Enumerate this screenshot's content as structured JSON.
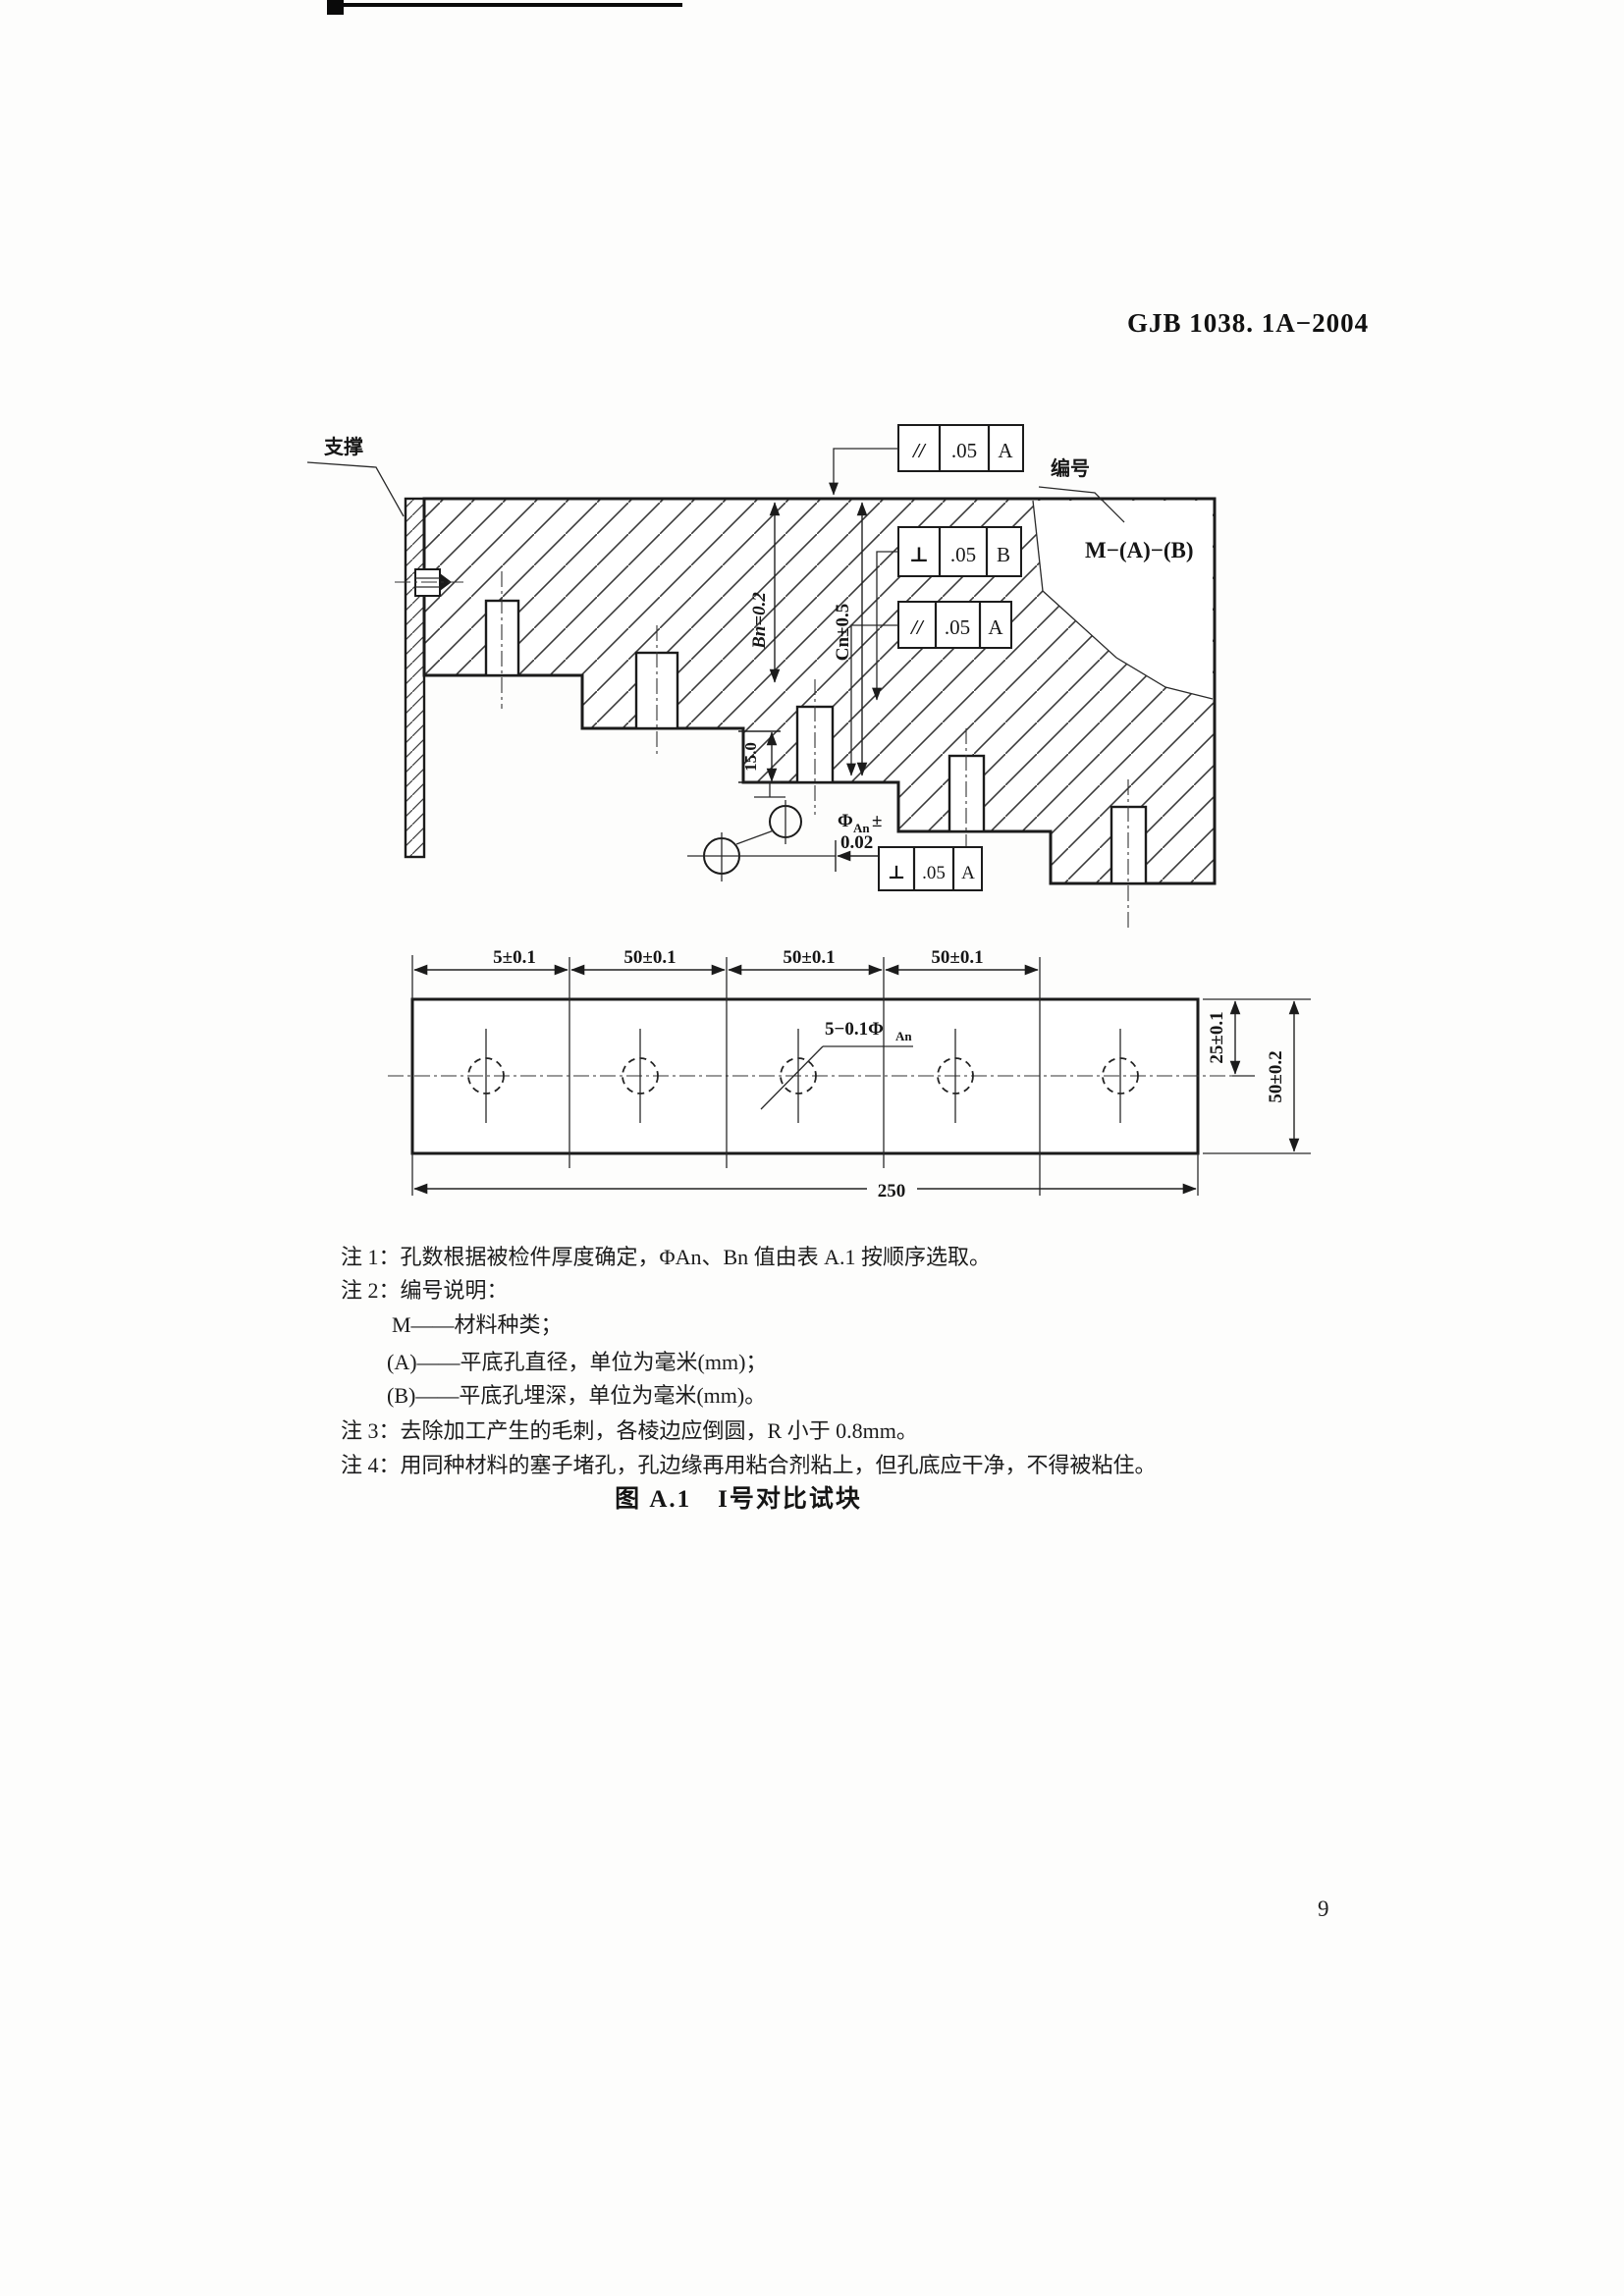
{
  "page": {
    "standard_number": "GJB 1038. 1A−2004",
    "page_number": "9"
  },
  "figure": {
    "caption": "图 A.1　I号对比试块",
    "section_view": {
      "support_label": "支撑",
      "id_label": "编号",
      "marking": "M−(A)−(B)",
      "frames": {
        "top": {
          "symbol": "//",
          "tolerance": ".05",
          "datum": "A"
        },
        "upper": {
          "symbol": "⊥",
          "tolerance": ".05",
          "datum": "B"
        },
        "lower": {
          "symbol": "//",
          "tolerance": ".05",
          "datum": "A"
        },
        "bottom": {
          "symbol": "⊥",
          "tolerance": ".05",
          "datum": "A"
        }
      },
      "dims": {
        "depth_b": "Bn=0.2",
        "depth_c": "Cn±0.5",
        "step_height": "15.0",
        "phi": "Φ",
        "phi_sub": "An",
        "phi_pm": "±",
        "phi_tol": "0.02"
      }
    },
    "plan_view": {
      "top_dims": [
        "5±0.1",
        "50±0.1",
        "50±0.1",
        "50±0.1"
      ],
      "callout": "5−0.1Φ",
      "callout_sub": "An",
      "right_inner_dim": "25±0.1",
      "right_outer_dim": "50±0.2",
      "total_dim": "250"
    }
  },
  "notes": [
    {
      "text": "注 1：孔数根据被检件厚度确定，ΦAn、Bn 值由表 A.1 按顺序选取。"
    },
    {
      "text": "注 2：编号说明："
    },
    {
      "text": "M——材料种类；"
    },
    {
      "text": "(A)——平底孔直径，单位为毫米(mm)；"
    },
    {
      "text": "(B)——平底孔埋深，单位为毫米(mm)。"
    },
    {
      "text": "注 3：去除加工产生的毛刺，各棱边应倒圆，R 小于 0.8mm。"
    },
    {
      "text": "注 4：用同种材料的塞子堵孔，孔边缘再用粘合剂粘上，但孔底应干净，不得被粘住。"
    }
  ]
}
